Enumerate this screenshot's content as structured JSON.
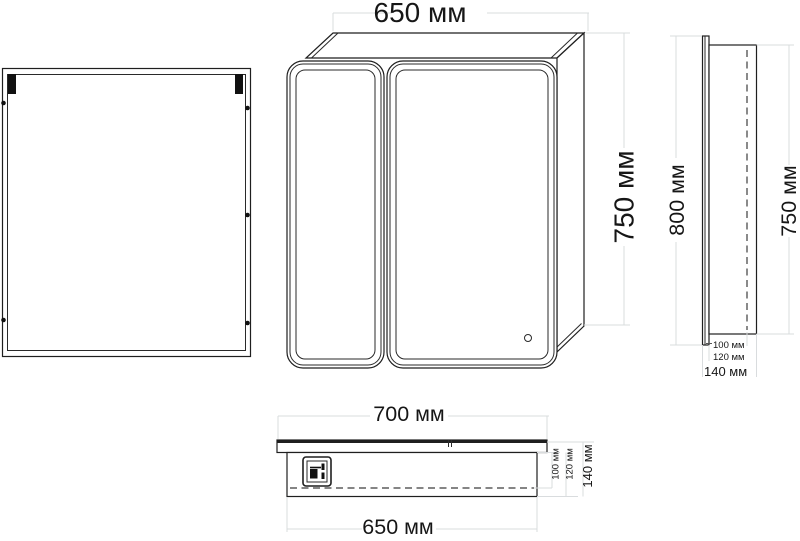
{
  "drawing": {
    "unit": "мм",
    "front_view": {
      "width_label": "650 мм",
      "height_label": "750 мм"
    },
    "side_view": {
      "mirror_height_label": "800 мм",
      "body_height_label": "750 мм",
      "depth_inner_label": "100 мм",
      "depth_body_label": "120 мм",
      "depth_total_label": "140 мм"
    },
    "top_view": {
      "doors_width_label": "700 мм",
      "body_width_label": "650 мм",
      "depth_inner_label": "100 мм",
      "depth_body_label": "120 мм",
      "depth_total_label": "140 мм"
    },
    "colors": {
      "line": "#1f1f1f",
      "dimension_line": "#d9dcde",
      "text": "#161616",
      "background": "#ffffff"
    }
  }
}
